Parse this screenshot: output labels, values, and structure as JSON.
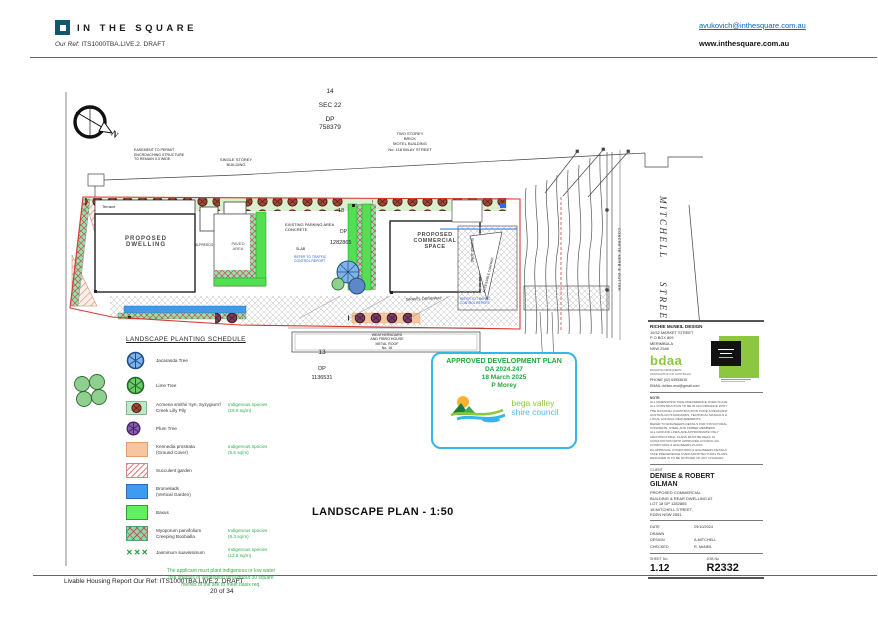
{
  "header": {
    "brand": "IN THE SQUARE",
    "ref_label": "Our Ref:",
    "ref_value": "ITS1000TBA.LIVE.2. DRAFT",
    "email": "avukovich@inthesquare.com.au",
    "website": "www.inthesquare.com.au"
  },
  "plan": {
    "title": "LANDSCAPE PLAN  - 1:50",
    "north_label": "N",
    "lot14": "14",
    "sec22": "SEC 22",
    "dp_label": "DP",
    "dp14": "758379",
    "lot13": "13",
    "dp13": "1136531",
    "lot18": "18",
    "dp18": "1282865",
    "labels": {
      "easement": "EASEMENT TO PERMIT\nENCROACHING STRUCTURE\nTO REMAIN 0.3 WIDE",
      "single_storey": "SINGLE STOREY\nBUILDING",
      "motel": "TWO STOREY\nBRICK\nMOTEL BUILDING\nNo. 118 IMLAY STREET",
      "terrace": "Terrace",
      "dwelling": "PROPOSED\nDWELLING",
      "alfresco": "ALFRESCO",
      "paved": "PAVED\nAREA",
      "parking": "EXISTING PARKING AREA\nCONCRETE",
      "slab": "SLAB",
      "traffic_note": "REFER TO TRAFFIC\nCONTROL REPORT",
      "commercial": "PROPOSED\nCOMMERCIAL\nSPACE",
      "shared_zone": "SHARED ZONE",
      "accessible": "ACCESSIBLE CARPARK",
      "driveway": "GRAVEL DRIVEWAY",
      "house": "WEATHERBOARD\nAND FIBRO HOUSE\nMETAL ROOF\nNo. 16",
      "kerb": "CONCRETE KERB & GUTTER",
      "street_1": "MITCHELL",
      "street_2": "STREET"
    }
  },
  "legend": {
    "title": "LANDSCAPE PLANTING SCHEDULE",
    "items": [
      {
        "label": "Jacaranda Tree",
        "note": ""
      },
      {
        "label": "Lime Tree",
        "note": ""
      },
      {
        "label": "Acmena smithii 'syn. Syzygium'/\nCreek Lilly Pily",
        "note": "Indigenous species\n(16.5 sq/m)"
      },
      {
        "label": "Plum Tree",
        "note": ""
      },
      {
        "label": "Kennedia prostrata\n(Ground Cover)",
        "note": "Indigenous species\n(5.5 sq/m)"
      },
      {
        "label": "Succulent garden",
        "note": ""
      },
      {
        "label": "Bromeliads\n(Vertical Garden)",
        "note": ""
      },
      {
        "label": "Baxus",
        "note": ""
      },
      {
        "label": "Myoporum parvifolium\nCreeping Boobialla",
        "note": "Indigenous species\n(8.3 sq/m)"
      },
      {
        "label": "Jasminum suavissimum",
        "note": "Indigenous species\n(12.8 sq/m)"
      }
    ],
    "basix_note": "The applicant must plant indigenous or low water\nuse species of vegetation throughout 30 square\nmetres of the site to meet basix req."
  },
  "stamp": {
    "title": "APPROVED DEVELOPMENT PLAN",
    "da": "DA 2024.247",
    "date": "18 March 2025",
    "officer": "P Morey",
    "council_line1": "bega valley",
    "council_line2": "shire council"
  },
  "titleblock": {
    "firm": "RICHIE McNEIL DESIGN",
    "address": "10/32 MARKET STREET\nP O BOX 809\nMERIMBULA\nNSW    2548",
    "bdaa": "bdaa",
    "bdaa_sub": "BUILDING DESIGNERS\nASSOCIATION OF AUSTRALIA",
    "phone": "PHONE  (02) 64953616",
    "email": "EMAIL   richien.rmd@gmail.com",
    "note_label": "NOTE:",
    "notes": "ALL DIMENSIONS TAKE PRECEDENCE OVER SCALE\nALL CONSTRUCTION TO BE IN ACCORDANCE WITH\nTHE NATIONAL CONSTRUCTION CODE & RELEVANT\nAUSTRALIAN STANDARDS, TECHNICAL MANUALS &\nLOCAL COUNCIL REQUIREMENTS.\nREFER TO ENGINEERS DETAILS FOR STRUCTURAL\nCONCRETE, STEEL AND TIMBER MEMBERS.\nALL GROUND LINES ARE APPROXIMATE ONLY\nARCHITECTURAL PLANS MUST BE READ IN\nCONJUNCTION WITH APPROVED COUNCIL DA\nCONDITIONS & ENGINEERS PLANS.\nDA APPROVAL CONDITIONS & ENGINEERS DETAILS\nTAKE PRECEDENCE OVER ARCHITECTURAL PLANS.\nDESIGNER IS TO BE NOTIFIED OF ANY CHANGES",
    "client_label": "CLIENT",
    "client": "DENISE & ROBERT\nGILMAN",
    "project": "PROPOSED COMMERCIAL\nBUILDING & REAR DWELLING AT\nLOT 18 DP 1282865\n18 MITCHELL STREET,\nEDEN NSW 2551",
    "meta": [
      {
        "label": "DATE",
        "value": "29/10/2024"
      },
      {
        "label": "DRAWN",
        "value": ""
      },
      {
        "label": "DESIGN",
        "value": "A.MITCHELL"
      },
      {
        "label": "CHECKED",
        "value": "R. McNEIL"
      }
    ],
    "sheet_label": "SHEET No",
    "sheet": "1.12",
    "job_label": "JOB No",
    "job": "R2332"
  },
  "footer": {
    "line": "Livable Housing Report Our Ref: ITS1000TBA.LIVE.2. DRAFT",
    "page": "20 of 34"
  }
}
